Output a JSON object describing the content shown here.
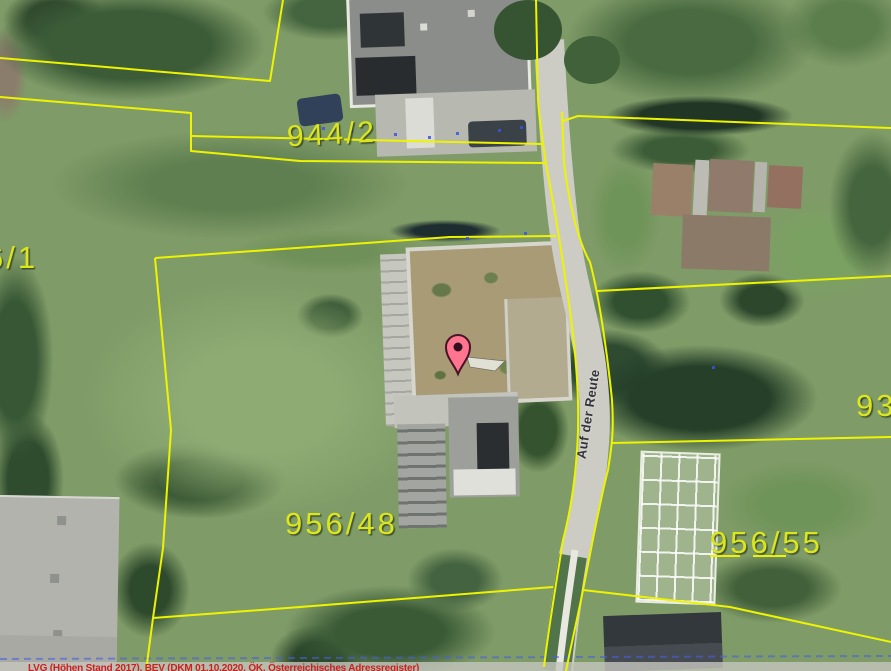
{
  "map": {
    "parcel_labels": {
      "left": "6/1",
      "top": "944/2",
      "center": "956/48",
      "right": "956/55",
      "right_edge": "93"
    },
    "street_name": "Auf der Reute",
    "attribution": "LVG (Höhen Stand 2017), BEV (DKM 01.10.2020, ÖK, Österreichisches Adressregister)",
    "marker": {
      "icon": "location-pin"
    },
    "colors": {
      "boundary": "#eef400",
      "label": "#dce61c",
      "street_text": "#33343a",
      "attribution_text": "#cc2020",
      "address_point": "#3a53e8",
      "pin": "#ff7590",
      "pin_outline": "#4a1426"
    }
  }
}
